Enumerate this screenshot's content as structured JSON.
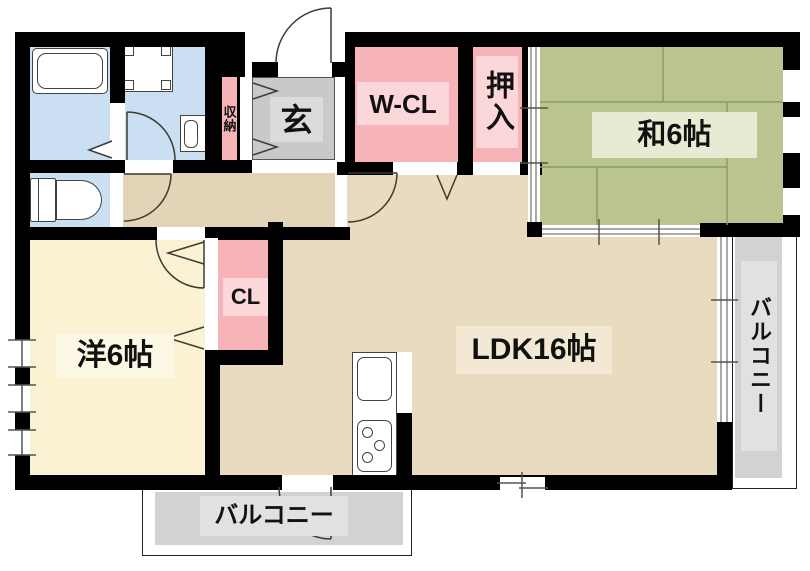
{
  "title": "apartment-floor-plan",
  "rooms": {
    "washitsu": {
      "label": "和6帖"
    },
    "yoshitsu": {
      "label": "洋6帖"
    },
    "ldk": {
      "label": "LDK16帖"
    },
    "wcl": {
      "label": "W-CL"
    },
    "oshiire": {
      "label": "押入"
    },
    "cl": {
      "label": "CL"
    },
    "genkan": {
      "label": "玄"
    },
    "shuno": {
      "label": "収納"
    },
    "balcony_bottom": {
      "label": "バルコニー"
    },
    "balcony_right": {
      "label": "バルコニー"
    }
  },
  "fixtures": [
    "bathtub",
    "washing-machine-pan",
    "vanity-sink",
    "toilet",
    "kitchen-sink",
    "gas-stove"
  ],
  "colors": {
    "wall": "#000000",
    "wet_area_blue": "#CBDFF2",
    "closet_pink": "#F6B4B9",
    "closet_pink_light": "#FBD7DA",
    "ldk_tan": "#E9DBC0",
    "hall_tan": "#E3D4B7",
    "western_room_cream": "#FBF2D3",
    "japanese_room_green": "#B9C48F",
    "tatami_line": "#8E9965",
    "entrance_gray": "#C9C9C9",
    "balcony_gray": "#D2D2D2",
    "line": "#3C3C34"
  }
}
